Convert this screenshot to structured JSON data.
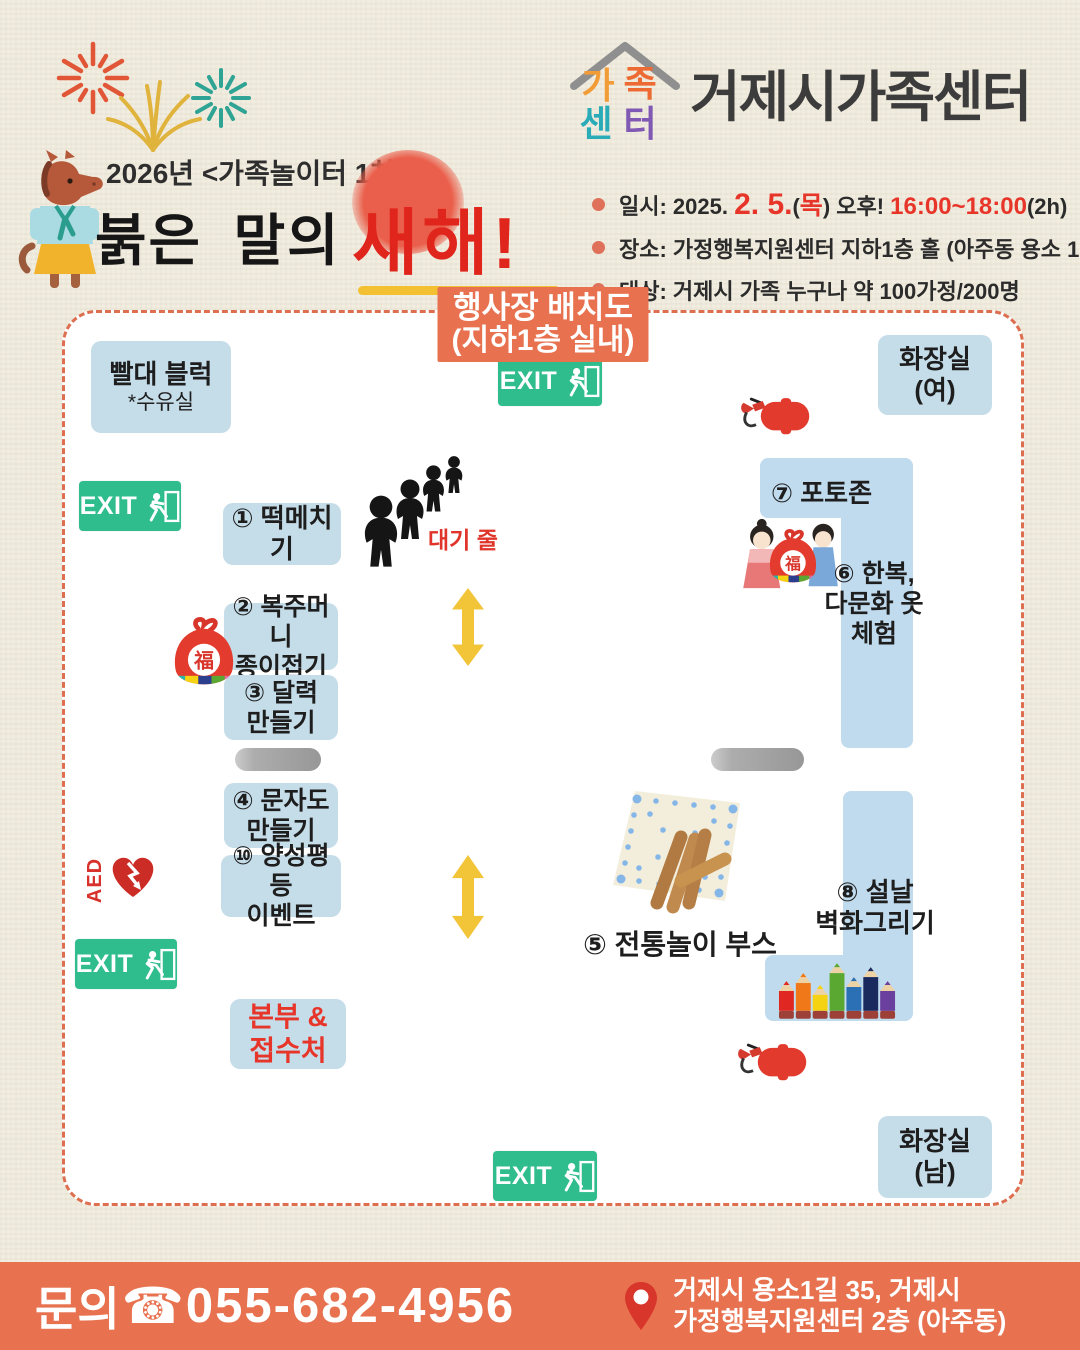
{
  "colors": {
    "accent": "#e8724f",
    "booth_blue": "#c5dde9",
    "exit_green": "#2fbd8d",
    "alert_red": "#e0342b",
    "arrow_yellow": "#f2c438"
  },
  "header": {
    "logo_chars": [
      "가",
      "족",
      "센",
      "터"
    ],
    "org_name": "거제시가족센터",
    "event_series": "2026년 <가족놀이터 1차>",
    "title_black": "붉은 말의",
    "title_red": "새해!",
    "details": {
      "line1": {
        "b1": "일시: 2025. ",
        "r1": "2. 5.",
        "b2": "(",
        "r2": "목",
        "b3": ") 오후! ",
        "r3": "16:00~18:00",
        "b4": "(2h)"
      },
      "line2": "장소: 가정행복지원센터 지하1층 홀 (아주동 용소 1길35)",
      "line3": "대상: 거제시 가족 누구나 약 100가정/200명"
    }
  },
  "map": {
    "title_line1": "행사장 배치도",
    "title_line2": "(지하1층 실내)",
    "exit_label": "EXIT",
    "queue_label": "대기 줄",
    "aed_label": "AED",
    "pouch_char": "福",
    "rooms": {
      "straw_block": {
        "line1": "빨대 블럭",
        "line2": "*수유실"
      },
      "restroom_women": {
        "line1": "화장실",
        "line2": "(여)"
      },
      "restroom_men": {
        "line1": "화장실",
        "line2": "(남)"
      }
    },
    "booths": {
      "tteok": "① 떡메치기",
      "pouch": {
        "line1": "② 복주머니",
        "line2": "종이접기"
      },
      "calendar": {
        "line1": "③ 달력",
        "line2": "만들기"
      },
      "letters": {
        "line1": "④ 문자도",
        "line2": "만들기"
      },
      "gender": {
        "line1": "⑩ 양성평등",
        "line2": "이벤트"
      },
      "hq": {
        "line1": "본부 &",
        "line2": "접수처"
      },
      "photozone": "⑦ 포토존",
      "hanbok": {
        "line1": "⑥ 한복,",
        "line2": "다문화 옷",
        "line3": "체험"
      },
      "folk": "⑤ 전통놀이 부스",
      "mural": {
        "line1": "⑧ 설날",
        "line2": "벽화그리기"
      }
    }
  },
  "footer": {
    "inquiry_label": "문의",
    "phone_icon": "☎",
    "phone": "055-682-4956",
    "address_line1": "거제시 용소1길 35,  거제시",
    "address_line2": "가정행복지원센터 2층 (아주동)"
  }
}
